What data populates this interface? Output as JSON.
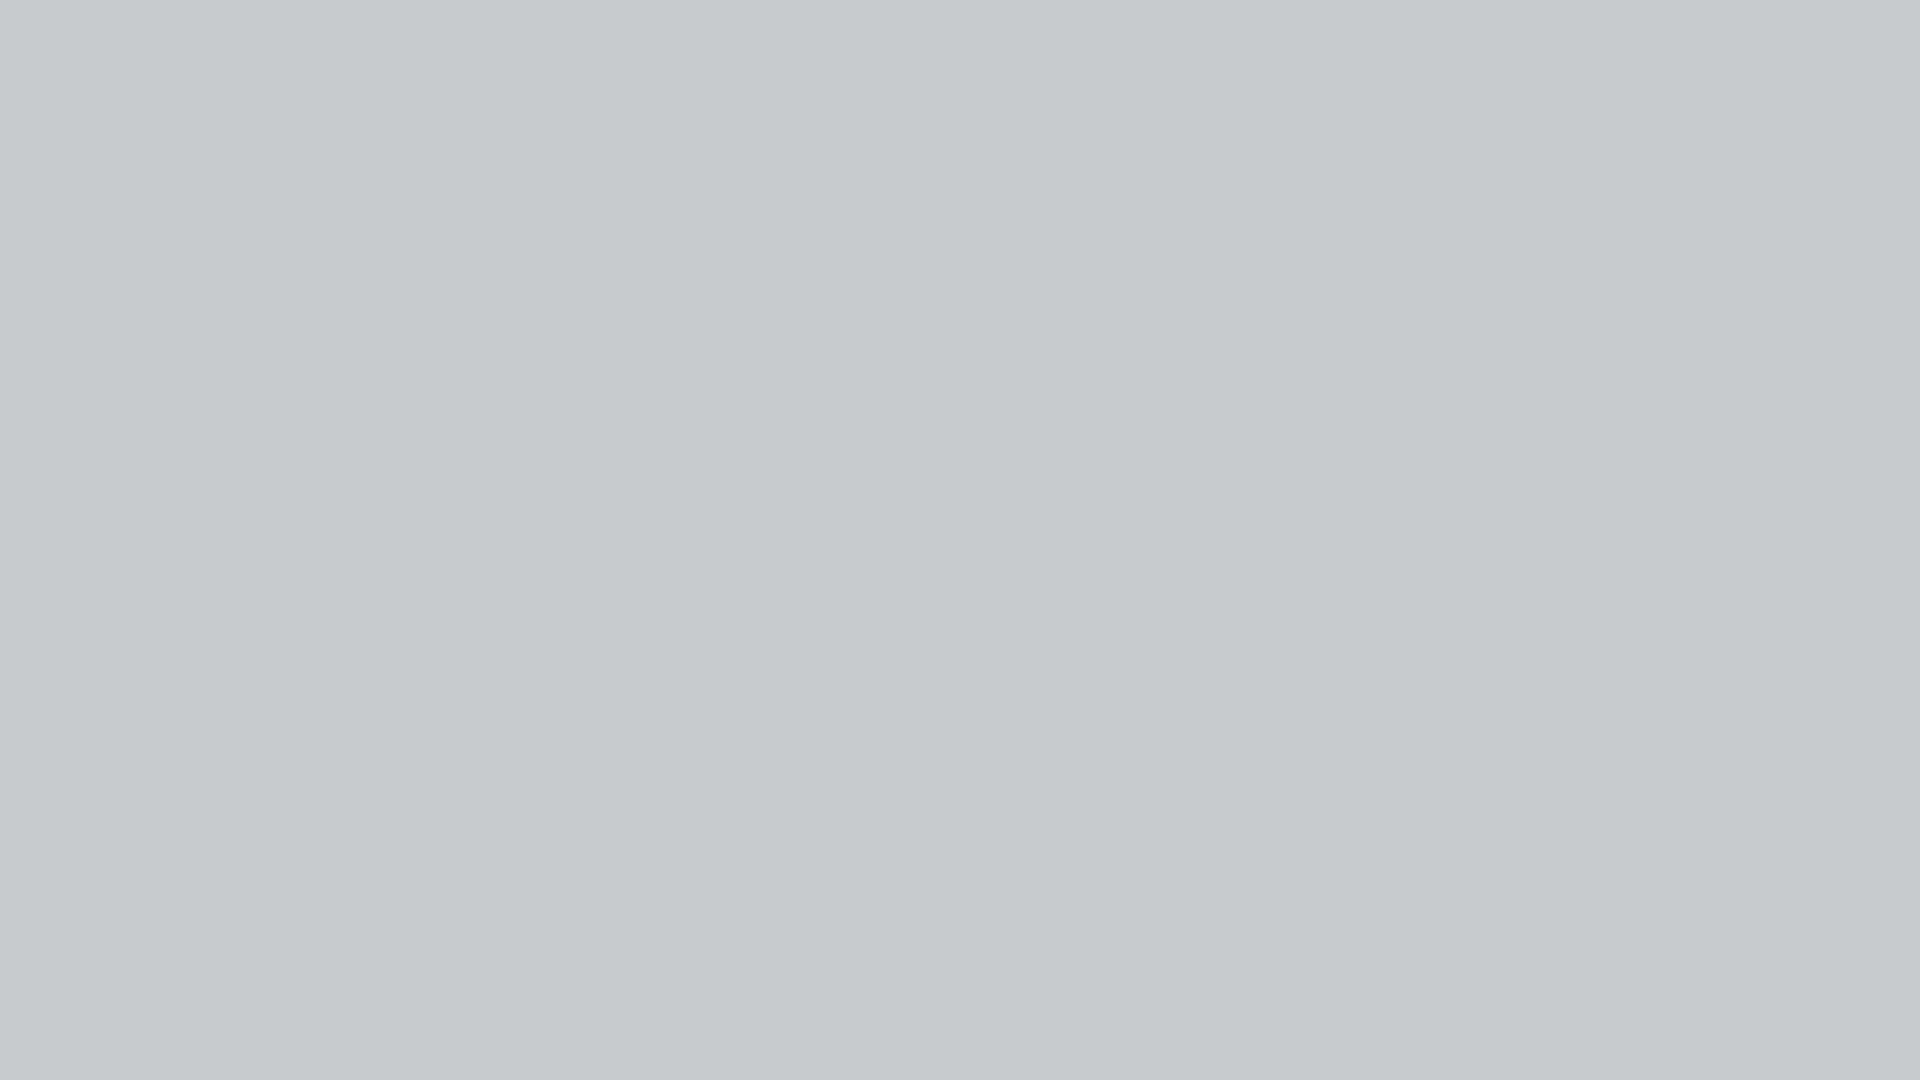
{
  "scene": {
    "width": 1920,
    "height": 1080,
    "description": "Aerial 3D architectural rendering of a block manufacturing plant compound: perimeter fence with blue posts, tree-lined roads, white block storage yard with gantry crane, white silos, green production floor with cutting machines and conveyor lines, entrance gate with guard house, diagonal parking lots full of cars, and a main road in the foreground.",
    "on_screen_text": [],
    "logo": {
      "legible": false,
      "color": "#2f6fc4"
    }
  },
  "palette": {
    "pavement": "#cdd2d5",
    "green": "#2d6a44",
    "grass": "#7fa05c",
    "road": "#5d6770",
    "sidewalk": "#ccd2d5",
    "laneWhite": "#e8ecee",
    "fencePanel": "#dde2e5",
    "fencePost": "#4e9bd3",
    "yellow": "#f2b824",
    "yellowLine": "#e6c439",
    "white": "#f2f4f5",
    "blue": "#2f6fc4",
    "dark": "#2e3338",
    "barrierRed": "#cf3a33",
    "paver": "#e6ecdc",
    "car": {
      "white": "#eef1f2",
      "black": "#1e2226",
      "indigo": "#3d4284",
      "darkblue": "#2d3560",
      "silver": "#c6cbd0",
      "maroon": "#5c2129",
      "red": "#8e2230",
      "purple": "#52418f"
    }
  },
  "areas": {
    "compound": "193,142 1757,128 1920,615 1920,940 62,940 38,762",
    "green": "297,428 1690,416 1744,516 1744,688 1160,698 1152,768 242,774",
    "left_grass": "0,0 196,140 40,760 0,760",
    "right_grass": "1758,124 1920,94 1920,286 1814,302",
    "ne_road": "1742,0 1920,0 1920,116 1788,54",
    "ne_dashes": [
      [
        1806,
        4
      ],
      [
        1846,
        16
      ]
    ],
    "ne_yellow": [
      1872,
      4
    ]
  },
  "rails": {
    "h": [
      [
        435,
        262,
        888
      ],
      [
        400,
        377,
        870
      ]
    ],
    "bumpers": [
      [
        428,
        254
      ],
      [
        1318,
        254
      ]
    ],
    "v_xs": [
      446,
      502,
      558,
      614,
      670,
      726,
      782,
      838,
      894,
      950,
      1006,
      1062,
      1118
    ],
    "v_y": 265,
    "v_h": 163,
    "bogie": [
      396,
      367
    ]
  },
  "yard_stacks": {
    "groups": [
      [
        428,
        240,
        4,
        2
      ],
      [
        634,
        238,
        4,
        2
      ],
      [
        826,
        236,
        4,
        2
      ],
      [
        1036,
        234,
        4,
        2
      ],
      [
        1252,
        232,
        4,
        2
      ],
      [
        1452,
        278,
        3,
        2
      ],
      [
        1630,
        276,
        3,
        2
      ],
      [
        1794,
        234,
        2,
        3
      ]
    ],
    "singles_y": 344,
    "singles_xs": [
      392,
      452,
      512,
      572,
      632,
      692,
      752,
      812,
      872,
      932,
      992,
      1052,
      1112
    ],
    "stack_w": 46,
    "stack_h": 44,
    "dx": 52,
    "dy": 52
  },
  "tables": [
    [
      372,
      386
    ],
    [
      487,
      387
    ],
    [
      602,
      383
    ]
  ],
  "pallets": [
    [
      694,
      392
    ],
    [
      758,
      395
    ]
  ],
  "crane": {
    "x": 538,
    "y": 90
  },
  "silos": {
    "x": 190,
    "y": 296,
    "cascade": [
      [
        14,
        34
      ],
      [
        8,
        82
      ],
      [
        2,
        130
      ],
      [
        -2,
        178
      ],
      [
        -6,
        226
      ]
    ],
    "small": [
      [
        62,
        6
      ],
      [
        98,
        20
      ]
    ]
  },
  "green_marks": {
    "lines": [
      [
        1005,
        464,
        735
      ],
      [
        1005,
        518,
        737
      ]
    ],
    "stub": [
      1005,
      518,
      3,
      42
    ],
    "rect": [
      1238,
      648,
      482,
      40
    ]
  },
  "turntables": [
    [
      388,
      602,
      44,
      26
    ],
    [
      374,
      658,
      42,
      26
    ],
    [
      334,
      714,
      40,
      24
    ],
    [
      314,
      744,
      38,
      22
    ],
    [
      248,
      744,
      36,
      22
    ],
    [
      770,
      448,
      48,
      28
    ],
    [
      778,
      536,
      42,
      24
    ],
    [
      956,
      536,
      42,
      24
    ]
  ],
  "conveyors": [
    [
      396,
      600,
      250,
      16
    ],
    [
      415,
      652,
      285,
      16
    ],
    [
      352,
      716,
      1096,
      16
    ],
    [
      246,
      744,
      92,
      14
    ],
    [
      1040,
      444,
      112,
      18
    ]
  ],
  "conv_vert": [
    [
      382,
      598,
      16,
      150
    ]
  ],
  "white_tables": [
    [
      398,
      592,
      50,
      22
    ],
    [
      610,
      592,
      46,
      22
    ],
    [
      418,
      644,
      40,
      24
    ],
    [
      646,
      644,
      52,
      24
    ],
    [
      358,
      708,
      62,
      24
    ],
    [
      1310,
      708,
      92,
      20
    ]
  ],
  "spool_machines": [
    [
      478,
      698,
      92,
      40
    ],
    [
      558,
      642,
      58,
      36
    ],
    [
      818,
      696,
      150,
      44
    ],
    [
      1006,
      698,
      42,
      44
    ],
    [
      1260,
      700,
      50,
      40
    ]
  ],
  "box_machines": [
    [
      598,
      704,
      60,
      40
    ],
    [
      698,
      684,
      28,
      18
    ],
    [
      760,
      684,
      28,
      18
    ]
  ],
  "roll_racks": [
    [
      964,
      702,
      42,
      50
    ],
    [
      1076,
      712,
      86,
      26
    ],
    [
      1158,
      710,
      66,
      24
    ]
  ],
  "blue_rack": [
    1042,
    696,
    30,
    48
  ],
  "bales": [
    [
      944,
      444,
      36,
      34
    ],
    [
      944,
      488,
      36,
      34
    ],
    [
      944,
      528,
      36,
      34
    ]
  ],
  "cabinets": [
    [
      802,
      430,
      32,
      22
    ],
    [
      872,
      552,
      26,
      18
    ]
  ],
  "green_boxes": [
    [
      372,
      444,
      46,
      32
    ],
    [
      374,
      492,
      44,
      32
    ],
    [
      312,
      366,
      36,
      28
    ]
  ],
  "mixer": {
    "x": 462,
    "y": 556,
    "w": 68,
    "h": 78
  },
  "towers": [
    [
      500,
      560,
      34,
      128
    ],
    [
      328,
      686,
      52,
      78
    ]
  ],
  "cutters": {
    "xs": [
      462,
      528,
      594
    ],
    "y": 428,
    "w": 54,
    "h": 128
  },
  "portals": [
    [
      718,
      442
    ],
    [
      845,
      440
    ]
  ],
  "disc_machines": [
    [
      828,
      382
    ],
    [
      963,
      384
    ]
  ],
  "blue_machines": {
    "gantry": [
      1112,
      418,
      48,
      48
    ],
    "flat": [
      1256,
      430,
      56,
      38
    ],
    "posts": [
      1326,
      426,
      68,
      44
    ]
  },
  "green_stack_bands": [
    {
      "y": 514,
      "w": 46,
      "sh": 16,
      "xs": [
        1226,
        1286,
        1345,
        1402,
        1540,
        1597,
        1653
      ]
    },
    {
      "y": 582,
      "w": 48,
      "sh": 17,
      "xs": [
        1242,
        1300,
        1358,
        1416,
        1474,
        1560,
        1617,
        1673
      ]
    }
  ],
  "fences": {
    "top": {
      "x": 188,
      "y": 138,
      "len": 1572,
      "rot": -0.45,
      "step": 56
    },
    "left": {
      "x": 188,
      "y": 146,
      "len": 622,
      "rot": 14.3,
      "step": 56
    },
    "right": {
      "x": 1751,
      "y": 124,
      "len": 522,
      "rot": -18.3,
      "step": 56
    },
    "bottom_left": {
      "x": 58,
      "y": 938,
      "len": 684,
      "step": 56
    },
    "bottom_right": {
      "x": 1188,
      "y": 938,
      "len": 732,
      "step": 56
    },
    "outer_left": {
      "x": 140,
      "y": 76,
      "len": 600,
      "rot": 15.5,
      "step": 50
    }
  },
  "parking": {
    "y": 880,
    "h": 58,
    "left": {
      "x": 62,
      "w": 676,
      "start": 76,
      "step": 44,
      "items": [
        "white",
        "maroon",
        "indigo",
        "black",
        "black",
        "tree",
        "white",
        "silver",
        "tree",
        "maroon",
        "tree",
        "white",
        "indigo",
        "tree",
        "purple"
      ]
    },
    "right": {
      "x": 1188,
      "w": 732,
      "start": 1196,
      "step": 44,
      "items": [
        "black",
        "black",
        "maroon",
        "white",
        "black",
        "indigo",
        "none",
        "tree",
        "white",
        "maroon",
        "indigo",
        "silver",
        "tree",
        "black",
        "white",
        "red",
        "silver"
      ]
    }
  },
  "gate": {
    "wall_left": [
      740,
      888,
      88,
      22
    ],
    "wall_cap": [
      818,
      886,
      16,
      26
    ],
    "accordion": [
      828,
      892,
      158,
      18
    ],
    "end_post": [
      980,
      888,
      8,
      24
    ],
    "barrier": [
      988,
      902,
      64,
      6
    ],
    "barrier_post": [
      1048,
      896,
      8,
      14
    ]
  },
  "guard_house": {
    "roof": [
      1042,
      862,
      152,
      50
    ],
    "wall": [
      1058,
      904,
      124,
      34
    ],
    "west_face": [
      1058,
      898,
      14,
      40
    ],
    "windows": [
      [
        1090,
        912,
        26,
        15
      ],
      [
        1126,
        910,
        30,
        15
      ]
    ]
  },
  "hedges": [
    [
      893,
      920,
      72,
      26
    ],
    [
      1186,
      904,
      12,
      40
    ]
  ],
  "bands": {
    "grass_strip": [
      0,
      962,
      1920,
      14
    ],
    "sidewalk": [
      0,
      976,
      1920,
      32
    ],
    "corner": [
      0,
      950,
      92,
      130
    ],
    "driveway": [
      830,
      915,
      360,
      95
    ],
    "road": [
      0,
      1008,
      1920,
      72
    ]
  },
  "road_dashes": {
    "y": 1044,
    "x0": 12,
    "step": 74,
    "w": 44,
    "h": 6,
    "n": 26
  },
  "lamps": [
    [
      205,
      1004
    ],
    [
      742,
      1008
    ],
    [
      1300,
      966
    ],
    [
      1658,
      1006
    ]
  ],
  "driving_cars": [
    [
      92,
      818,
      "white",
      6
    ],
    [
      404,
      804,
      "indigo",
      5
    ],
    [
      672,
      810,
      "white",
      4
    ],
    [
      1180,
      804,
      "indigo",
      2
    ],
    [
      1528,
      822,
      "white",
      2
    ],
    [
      1840,
      802,
      "darkblue",
      2
    ]
  ],
  "trees": {
    "top_dark": [
      [
        20,
        10,
        46
      ],
      [
        115,
        16,
        40
      ],
      [
        210,
        8,
        50
      ],
      [
        305,
        18,
        42
      ],
      [
        400,
        6,
        48
      ],
      [
        495,
        14,
        40
      ],
      [
        590,
        8,
        52
      ],
      [
        685,
        16,
        44
      ],
      [
        780,
        6,
        46
      ],
      [
        875,
        14,
        40
      ],
      [
        970,
        18,
        50
      ],
      [
        1065,
        8,
        44
      ],
      [
        1160,
        14,
        46
      ],
      [
        1255,
        6,
        42
      ],
      [
        1350,
        16,
        50
      ],
      [
        1445,
        8,
        44
      ],
      [
        1540,
        14,
        40
      ],
      [
        1635,
        6,
        46
      ],
      [
        1705,
        20,
        36
      ]
    ],
    "mid_row": [
      [
        190,
        44,
        46
      ],
      [
        420,
        38,
        48
      ],
      [
        650,
        46,
        44
      ],
      [
        880,
        36,
        48
      ],
      [
        1110,
        44,
        46
      ],
      [
        1340,
        38,
        44
      ],
      [
        1570,
        46,
        42
      ]
    ],
    "top_row": [
      [
        130,
        92,
        42
      ],
      [
        248,
        104,
        38
      ],
      [
        366,
        88,
        44
      ],
      [
        484,
        102,
        40
      ],
      [
        602,
        90,
        46
      ],
      [
        720,
        104,
        40
      ],
      [
        838,
        88,
        44
      ],
      [
        956,
        102,
        40
      ],
      [
        1074,
        92,
        46
      ],
      [
        1192,
        104,
        40
      ],
      [
        1310,
        90,
        44
      ],
      [
        1428,
        102,
        40
      ],
      [
        1546,
        90,
        42
      ],
      [
        1664,
        102,
        38
      ],
      [
        1730,
        96,
        34
      ]
    ],
    "left": [
      [
        24,
        70,
        52
      ],
      [
        100,
        44,
        44
      ],
      [
        32,
        200,
        54
      ],
      [
        108,
        170,
        42
      ],
      [
        22,
        330,
        50
      ],
      [
        94,
        296,
        42
      ],
      [
        38,
        452,
        50
      ],
      [
        106,
        414,
        38
      ],
      [
        28,
        572,
        46
      ],
      [
        90,
        532,
        36
      ],
      [
        44,
        655,
        40
      ],
      [
        14,
        18,
        56
      ]
    ],
    "right": [
      [
        1840,
        100,
        40
      ],
      [
        1886,
        160,
        44
      ],
      [
        1848,
        220,
        36
      ],
      [
        1892,
        262,
        34
      ],
      [
        1876,
        66,
        34
      ],
      [
        1906,
        320,
        30
      ]
    ]
  }
}
